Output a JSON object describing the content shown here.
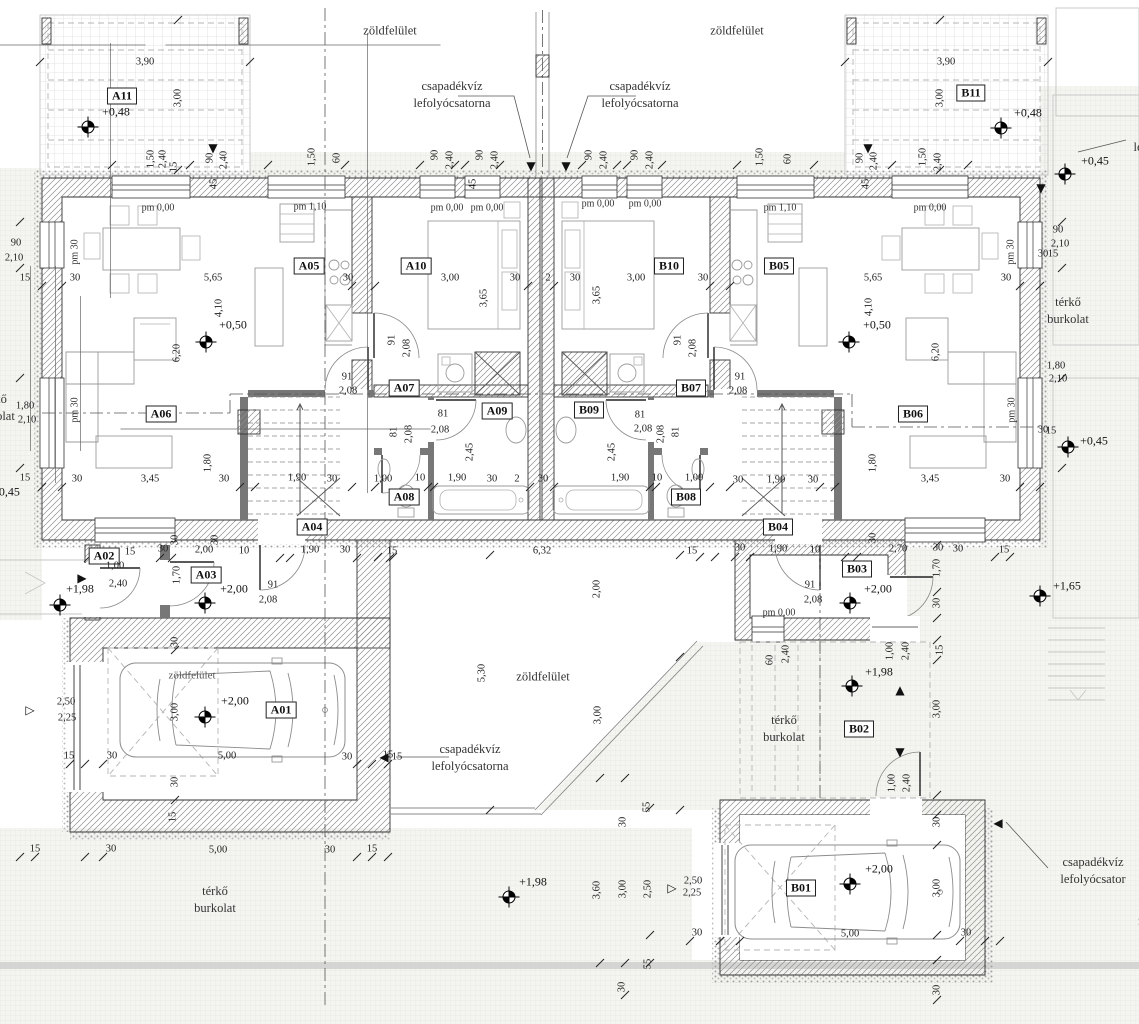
{
  "colors": {
    "paper": "#ffffff",
    "line": "#333333",
    "dim_text": "#222222",
    "light_line": "#9b9b9b",
    "paving": "#f4f4f1",
    "band": "#cfcfcf"
  },
  "rooms": [
    {
      "id": "A11",
      "x": 122,
      "y": 96
    },
    {
      "id": "B11",
      "x": 971,
      "y": 93
    },
    {
      "id": "A05",
      "x": 309,
      "y": 266
    },
    {
      "id": "A10",
      "x": 416,
      "y": 266
    },
    {
      "id": "B10",
      "x": 669,
      "y": 266
    },
    {
      "id": "B05",
      "x": 779,
      "y": 266
    },
    {
      "id": "A06",
      "x": 161,
      "y": 414
    },
    {
      "id": "B06",
      "x": 913,
      "y": 414
    },
    {
      "id": "A07",
      "x": 404,
      "y": 388
    },
    {
      "id": "B07",
      "x": 691,
      "y": 388
    },
    {
      "id": "A09",
      "x": 497,
      "y": 411
    },
    {
      "id": "B09",
      "x": 589,
      "y": 410
    },
    {
      "id": "A08",
      "x": 404,
      "y": 497
    },
    {
      "id": "B08",
      "x": 686,
      "y": 497
    },
    {
      "id": "A04",
      "x": 312,
      "y": 527
    },
    {
      "id": "B04",
      "x": 778,
      "y": 527
    },
    {
      "id": "A02",
      "x": 104,
      "y": 556
    },
    {
      "id": "A03",
      "x": 206,
      "y": 575
    },
    {
      "id": "B03",
      "x": 857,
      "y": 569
    },
    {
      "id": "B02",
      "x": 859,
      "y": 729
    },
    {
      "id": "A01",
      "x": 281,
      "y": 710
    },
    {
      "id": "B01",
      "x": 801,
      "y": 888
    }
  ],
  "dims": [
    {
      "t": "3,90",
      "x": 145,
      "y": 62
    },
    {
      "t": "3,00",
      "x": 178,
      "y": 98,
      "r": 1
    },
    {
      "t": "3,90",
      "x": 946,
      "y": 62
    },
    {
      "t": "3,00",
      "x": 940,
      "y": 98,
      "r": 1
    },
    {
      "t": "1,50",
      "x": 151,
      "y": 159,
      "r": 1
    },
    {
      "t": "2,40",
      "x": 163,
      "y": 159,
      "r": 1
    },
    {
      "t": "15",
      "x": 174,
      "y": 167,
      "r": 1
    },
    {
      "t": "90",
      "x": 210,
      "y": 158,
      "r": 1
    },
    {
      "t": "2,40",
      "x": 224,
      "y": 160,
      "r": 1
    },
    {
      "t": "45",
      "x": 214,
      "y": 184,
      "r": 1
    },
    {
      "t": "1,50",
      "x": 312,
      "y": 157,
      "r": 1
    },
    {
      "t": "60",
      "x": 337,
      "y": 158,
      "r": 1
    },
    {
      "t": "90",
      "x": 435,
      "y": 155,
      "r": 1
    },
    {
      "t": "2,40",
      "x": 450,
      "y": 160,
      "r": 1
    },
    {
      "t": "90",
      "x": 480,
      "y": 155,
      "r": 1
    },
    {
      "t": "2,40",
      "x": 495,
      "y": 160,
      "r": 1
    },
    {
      "t": "45",
      "x": 473,
      "y": 184,
      "r": 1
    },
    {
      "t": "90",
      "x": 589,
      "y": 155,
      "r": 1
    },
    {
      "t": "2,40",
      "x": 604,
      "y": 160,
      "r": 1
    },
    {
      "t": "90",
      "x": 635,
      "y": 155,
      "r": 1
    },
    {
      "t": "2,40",
      "x": 650,
      "y": 160,
      "r": 1
    },
    {
      "t": "1,50",
      "x": 760,
      "y": 157,
      "r": 1
    },
    {
      "t": "60",
      "x": 788,
      "y": 159,
      "r": 1
    },
    {
      "t": "45",
      "x": 866,
      "y": 184,
      "r": 1
    },
    {
      "t": "90",
      "x": 860,
      "y": 158,
      "r": 1
    },
    {
      "t": "2,40",
      "x": 874,
      "y": 161,
      "r": 1
    },
    {
      "t": "1,50",
      "x": 923,
      "y": 157,
      "r": 1
    },
    {
      "t": "2,40",
      "x": 938,
      "y": 162,
      "r": 1
    },
    {
      "t": "90",
      "x": 16,
      "y": 243
    },
    {
      "t": "2,10",
      "x": 14,
      "y": 258
    },
    {
      "t": "15",
      "x": 25,
      "y": 278
    },
    {
      "t": "30",
      "x": 75,
      "y": 278
    },
    {
      "t": "1,80",
      "x": 25,
      "y": 406
    },
    {
      "t": "2,10",
      "x": 27,
      "y": 420
    },
    {
      "t": "15",
      "x": 25,
      "y": 478
    },
    {
      "t": "90",
      "x": 1058,
      "y": 230
    },
    {
      "t": "2,10",
      "x": 1060,
      "y": 244
    },
    {
      "t": "30",
      "x": 1043,
      "y": 254
    },
    {
      "t": "15",
      "x": 1053,
      "y": 254
    },
    {
      "t": "1,80",
      "x": 1056,
      "y": 366
    },
    {
      "t": "2,10",
      "x": 1058,
      "y": 379
    },
    {
      "t": "30",
      "x": 1043,
      "y": 430
    },
    {
      "t": "15",
      "x": 1051,
      "y": 431
    },
    {
      "t": "5,65",
      "x": 213,
      "y": 278
    },
    {
      "t": "30",
      "x": 348,
      "y": 278
    },
    {
      "t": "3,00",
      "x": 450,
      "y": 278
    },
    {
      "t": "30",
      "x": 515,
      "y": 278
    },
    {
      "t": "2",
      "x": 548,
      "y": 278
    },
    {
      "t": "30",
      "x": 575,
      "y": 278
    },
    {
      "t": "3,00",
      "x": 636,
      "y": 278
    },
    {
      "t": "30",
      "x": 703,
      "y": 278
    },
    {
      "t": "5,65",
      "x": 873,
      "y": 278
    },
    {
      "t": "30",
      "x": 1006,
      "y": 278
    },
    {
      "t": "4,10",
      "x": 219,
      "y": 308,
      "r": 1
    },
    {
      "t": "6,20",
      "x": 177,
      "y": 353,
      "r": 1
    },
    {
      "t": "3,65",
      "x": 484,
      "y": 298,
      "r": 1
    },
    {
      "t": "3,65",
      "x": 597,
      "y": 295,
      "r": 1
    },
    {
      "t": "4,10",
      "x": 869,
      "y": 307,
      "r": 1
    },
    {
      "t": "6,20",
      "x": 936,
      "y": 352,
      "r": 1
    },
    {
      "t": "91",
      "x": 392,
      "y": 340,
      "r": 1
    },
    {
      "t": "2,08",
      "x": 407,
      "y": 348,
      "r": 1
    },
    {
      "t": "91",
      "x": 678,
      "y": 340,
      "r": 1
    },
    {
      "t": "2,08",
      "x": 693,
      "y": 348,
      "r": 1
    },
    {
      "t": "91",
      "x": 347,
      "y": 377
    },
    {
      "t": "2,08",
      "x": 348,
      "y": 391
    },
    {
      "t": "91",
      "x": 740,
      "y": 377
    },
    {
      "t": "2,08",
      "x": 738,
      "y": 391
    },
    {
      "t": "81",
      "x": 443,
      "y": 414
    },
    {
      "t": "2,08",
      "x": 440,
      "y": 430
    },
    {
      "t": "81",
      "x": 640,
      "y": 415
    },
    {
      "t": "2,08",
      "x": 643,
      "y": 429
    },
    {
      "t": "81",
      "x": 394,
      "y": 432,
      "r": 1
    },
    {
      "t": "2,08",
      "x": 409,
      "y": 434,
      "r": 1
    },
    {
      "t": "81",
      "x": 676,
      "y": 432,
      "r": 1
    },
    {
      "t": "2,08",
      "x": 661,
      "y": 434,
      "r": 1
    },
    {
      "t": "91",
      "x": 273,
      "y": 585
    },
    {
      "t": "2,08",
      "x": 268,
      "y": 600
    },
    {
      "t": "91",
      "x": 810,
      "y": 585
    },
    {
      "t": "2,08",
      "x": 813,
      "y": 600
    },
    {
      "t": "2,45",
      "x": 470,
      "y": 452,
      "r": 1
    },
    {
      "t": "2,45",
      "x": 612,
      "y": 452,
      "r": 1
    },
    {
      "t": "30",
      "x": 77,
      "y": 479
    },
    {
      "t": "3,45",
      "x": 150,
      "y": 479
    },
    {
      "t": "1,80",
      "x": 208,
      "y": 463,
      "r": 1
    },
    {
      "t": "30",
      "x": 224,
      "y": 479
    },
    {
      "t": "1,90",
      "x": 297,
      "y": 478
    },
    {
      "t": "30",
      "x": 332,
      "y": 479
    },
    {
      "t": "1,00",
      "x": 383,
      "y": 479
    },
    {
      "t": "10",
      "x": 420,
      "y": 478
    },
    {
      "t": "1,90",
      "x": 457,
      "y": 478
    },
    {
      "t": "30",
      "x": 492,
      "y": 479
    },
    {
      "t": "2",
      "x": 517,
      "y": 479
    },
    {
      "t": "30",
      "x": 543,
      "y": 479
    },
    {
      "t": "1,90",
      "x": 620,
      "y": 478
    },
    {
      "t": "10",
      "x": 657,
      "y": 478
    },
    {
      "t": "1,00",
      "x": 694,
      "y": 478
    },
    {
      "t": "30",
      "x": 738,
      "y": 480
    },
    {
      "t": "1,90",
      "x": 776,
      "y": 480
    },
    {
      "t": "30",
      "x": 813,
      "y": 480
    },
    {
      "t": "1,80",
      "x": 873,
      "y": 463,
      "r": 1
    },
    {
      "t": "3,45",
      "x": 930,
      "y": 479
    },
    {
      "t": "30",
      "x": 1005,
      "y": 479
    },
    {
      "t": "15",
      "x": 392,
      "y": 551
    },
    {
      "t": "6,32",
      "x": 542,
      "y": 551
    },
    {
      "t": "15",
      "x": 692,
      "y": 551
    },
    {
      "t": "5,30",
      "x": 482,
      "y": 673,
      "r": 1
    },
    {
      "t": "2,00",
      "x": 597,
      "y": 589,
      "r": 1
    },
    {
      "t": "3,00",
      "x": 598,
      "y": 715,
      "r": 1
    },
    {
      "t": "30",
      "x": 623,
      "y": 822,
      "r": 1
    },
    {
      "t": "55",
      "x": 647,
      "y": 807,
      "r": 1
    },
    {
      "t": "15",
      "x": 397,
      "y": 757
    },
    {
      "t": "15",
      "x": 130,
      "y": 552
    },
    {
      "t": "30",
      "x": 163,
      "y": 549
    },
    {
      "t": "2,00",
      "x": 204,
      "y": 550
    },
    {
      "t": "10",
      "x": 244,
      "y": 551
    },
    {
      "t": "1,90",
      "x": 310,
      "y": 550
    },
    {
      "t": "30",
      "x": 345,
      "y": 550
    },
    {
      "t": "30",
      "x": 175,
      "y": 540,
      "r": 1
    },
    {
      "t": "30",
      "x": 215,
      "y": 540,
      "r": 1
    },
    {
      "t": "1,70",
      "x": 177,
      "y": 575,
      "r": 1
    },
    {
      "t": "1,00",
      "x": 115,
      "y": 566
    },
    {
      "t": "2,40",
      "x": 118,
      "y": 584
    },
    {
      "t": "30",
      "x": 740,
      "y": 548
    },
    {
      "t": "1,90",
      "x": 778,
      "y": 549
    },
    {
      "t": "10",
      "x": 815,
      "y": 550
    },
    {
      "t": "2,70",
      "x": 898,
      "y": 549
    },
    {
      "t": "30",
      "x": 938,
      "y": 548
    },
    {
      "t": "30",
      "x": 958,
      "y": 549
    },
    {
      "t": "15",
      "x": 1004,
      "y": 550
    },
    {
      "t": "30",
      "x": 873,
      "y": 538,
      "r": 1
    },
    {
      "t": "1,70",
      "x": 937,
      "y": 568,
      "r": 1
    },
    {
      "t": "30",
      "x": 937,
      "y": 603,
      "r": 1
    },
    {
      "t": "60",
      "x": 770,
      "y": 660,
      "r": 1
    },
    {
      "t": "2,40",
      "x": 786,
      "y": 654,
      "r": 1
    },
    {
      "t": "1,00",
      "x": 890,
      "y": 651,
      "r": 1
    },
    {
      "t": "2,40",
      "x": 906,
      "y": 651,
      "r": 1
    },
    {
      "t": "1,00",
      "x": 892,
      "y": 783,
      "r": 1
    },
    {
      "t": "2,40",
      "x": 907,
      "y": 783,
      "r": 1
    },
    {
      "t": "15",
      "x": 940,
      "y": 650,
      "r": 1
    },
    {
      "t": "3,00",
      "x": 937,
      "y": 709,
      "r": 1
    },
    {
      "t": "30",
      "x": 937,
      "y": 822,
      "r": 1
    },
    {
      "t": "3,00",
      "x": 175,
      "y": 712,
      "r": 1
    },
    {
      "t": "30",
      "x": 175,
      "y": 642,
      "r": 1
    },
    {
      "t": "30",
      "x": 175,
      "y": 782,
      "r": 1
    },
    {
      "t": "5,00",
      "x": 227,
      "y": 756
    },
    {
      "t": "30",
      "x": 112,
      "y": 756
    },
    {
      "t": "30",
      "x": 347,
      "y": 757
    },
    {
      "t": "15",
      "x": 69,
      "y": 756
    },
    {
      "t": "15",
      "x": 388,
      "y": 755
    },
    {
      "t": "2,50",
      "x": 66,
      "y": 702
    },
    {
      "t": "2,25",
      "x": 67,
      "y": 718
    },
    {
      "t": "15",
      "x": 173,
      "y": 817,
      "r": 1
    },
    {
      "t": "15",
      "x": 35,
      "y": 849
    },
    {
      "t": "30",
      "x": 111,
      "y": 849
    },
    {
      "t": "5,00",
      "x": 218,
      "y": 850
    },
    {
      "t": "30",
      "x": 330,
      "y": 850
    },
    {
      "t": "15",
      "x": 372,
      "y": 849
    },
    {
      "t": "3,00",
      "x": 937,
      "y": 888,
      "r": 1
    },
    {
      "t": "5,00",
      "x": 850,
      "y": 934
    },
    {
      "t": "30",
      "x": 697,
      "y": 933
    },
    {
      "t": "30",
      "x": 966,
      "y": 933
    },
    {
      "t": "30",
      "x": 937,
      "y": 990,
      "r": 1
    },
    {
      "t": "2,50",
      "x": 693,
      "y": 881
    },
    {
      "t": "2,25",
      "x": 692,
      "y": 893
    },
    {
      "t": "3,60",
      "x": 597,
      "y": 890,
      "r": 1
    },
    {
      "t": "3,00",
      "x": 623,
      "y": 889,
      "r": 1
    },
    {
      "t": "2,50",
      "x": 648,
      "y": 889,
      "r": 1
    },
    {
      "t": "55",
      "x": 648,
      "y": 964,
      "r": 1
    },
    {
      "t": "30",
      "x": 622,
      "y": 987,
      "r": 1
    }
  ],
  "levels": [
    {
      "t": "+0,48",
      "x": 116,
      "y": 112
    },
    {
      "t": "+0,48",
      "x": 1028,
      "y": 113
    },
    {
      "t": "+0,50",
      "x": 233,
      "y": 325
    },
    {
      "t": "+0,50",
      "x": 877,
      "y": 325
    },
    {
      "t": "+0,45",
      "x": 1095,
      "y": 161
    },
    {
      "t": "+0,45",
      "x": 1094,
      "y": 441
    },
    {
      "t": "+0,45",
      "x": 6,
      "y": 492
    },
    {
      "t": "+1,65",
      "x": 1067,
      "y": 586
    },
    {
      "t": "+1,98",
      "x": 80,
      "y": 589
    },
    {
      "t": "+2,00",
      "x": 234,
      "y": 589
    },
    {
      "t": "+2,00",
      "x": 235,
      "y": 701
    },
    {
      "t": "+2,00",
      "x": 878,
      "y": 589
    },
    {
      "t": "+1,98",
      "x": 879,
      "y": 672
    },
    {
      "t": "+2,00",
      "x": 879,
      "y": 869
    },
    {
      "t": "+1,98",
      "x": 533,
      "y": 882
    }
  ],
  "pm": [
    {
      "t": "pm 0,00",
      "x": 158,
      "y": 208
    },
    {
      "t": "pm 1,10",
      "x": 310,
      "y": 207
    },
    {
      "t": "pm 0,00",
      "x": 447,
      "y": 208
    },
    {
      "t": "pm 0,00",
      "x": 487,
      "y": 208
    },
    {
      "t": "pm 0,00",
      "x": 598,
      "y": 204
    },
    {
      "t": "pm 0,00",
      "x": 645,
      "y": 204
    },
    {
      "t": "pm 1,10",
      "x": 780,
      "y": 208
    },
    {
      "t": "pm 0,00",
      "x": 930,
      "y": 208
    },
    {
      "t": "pm 0,00",
      "x": 779,
      "y": 613
    },
    {
      "t": "pm 30",
      "x": 75,
      "y": 252,
      "r": 1
    },
    {
      "t": "pm 30",
      "x": 75,
      "y": 410,
      "r": 1
    },
    {
      "t": "pm 30",
      "x": 1011,
      "y": 252,
      "r": 1
    },
    {
      "t": "pm 30",
      "x": 1012,
      "y": 410,
      "r": 1
    }
  ],
  "areas": [
    {
      "lines": [
        "zöldfelület"
      ],
      "x": 390,
      "y": 31
    },
    {
      "lines": [
        "zöldfelület"
      ],
      "x": 737,
      "y": 31
    },
    {
      "lines": [
        "zöldfelület"
      ],
      "x": 543,
      "y": 677
    },
    {
      "lines": [
        "zöldfelület"
      ],
      "x": 192,
      "y": 676,
      "small": 1
    },
    {
      "lines": [
        "zöldfelület"
      ],
      "x": 1165,
      "y": 921
    },
    {
      "lines": [
        "csapadékvíz",
        "lefolyócsatorna"
      ],
      "x": 452,
      "y": 95
    },
    {
      "lines": [
        "csapadékvíz",
        "lefolyócsatorna"
      ],
      "x": 640,
      "y": 95
    },
    {
      "lines": [
        "csapadékvíz",
        "lefolyócsatorna"
      ],
      "x": 470,
      "y": 758
    },
    {
      "lines": [
        "csapadékvíz",
        "lefolyócsator"
      ],
      "x": 1093,
      "y": 871
    },
    {
      "lines": [
        "csapadékvíz",
        "lefolyócsatorna"
      ],
      "x": 1172,
      "y": 139
    },
    {
      "lines": [
        "térkő",
        "burkolat"
      ],
      "x": -6,
      "y": 408
    },
    {
      "lines": [
        "térkő",
        "burkolat"
      ],
      "x": 1068,
      "y": 311
    },
    {
      "lines": [
        "térkő",
        "burkolat"
      ],
      "x": 215,
      "y": 900
    },
    {
      "lines": [
        "térkő",
        "burkolat"
      ],
      "x": 784,
      "y": 729
    }
  ],
  "markers": [
    {
      "k": "survey",
      "x": 88,
      "y": 127
    },
    {
      "k": "survey",
      "x": 1001,
      "y": 128
    },
    {
      "k": "survey",
      "x": 206,
      "y": 342
    },
    {
      "k": "survey",
      "x": 849,
      "y": 342
    },
    {
      "k": "survey",
      "x": 1065,
      "y": 174
    },
    {
      "k": "survey",
      "x": 1068,
      "y": 447
    },
    {
      "k": "survey",
      "x": 60,
      "y": 605
    },
    {
      "k": "survey",
      "x": 205,
      "y": 603
    },
    {
      "k": "survey",
      "x": 205,
      "y": 717
    },
    {
      "k": "survey",
      "x": 509,
      "y": 897
    },
    {
      "k": "survey",
      "x": 850,
      "y": 603
    },
    {
      "k": "survey",
      "x": 852,
      "y": 686
    },
    {
      "k": "survey",
      "x": 850,
      "y": 884
    },
    {
      "k": "survey",
      "x": 1040,
      "y": 596
    },
    {
      "k": "down",
      "x": 213,
      "y": 148
    },
    {
      "k": "down",
      "x": 868,
      "y": 148
    },
    {
      "k": "down",
      "x": 531,
      "y": 166
    },
    {
      "k": "down",
      "x": 566,
      "y": 166
    },
    {
      "k": "down",
      "x": 1041,
      "y": 188
    },
    {
      "k": "down",
      "x": 900,
      "y": 752
    },
    {
      "k": "up",
      "x": 900,
      "y": 690
    },
    {
      "k": "right",
      "x": 82,
      "y": 578
    },
    {
      "k": "left",
      "x": 384,
      "y": 757
    },
    {
      "k": "left",
      "x": 998,
      "y": 823
    },
    {
      "k": "openright",
      "x": 30,
      "y": 710
    },
    {
      "k": "openright",
      "x": 672,
      "y": 888
    }
  ]
}
